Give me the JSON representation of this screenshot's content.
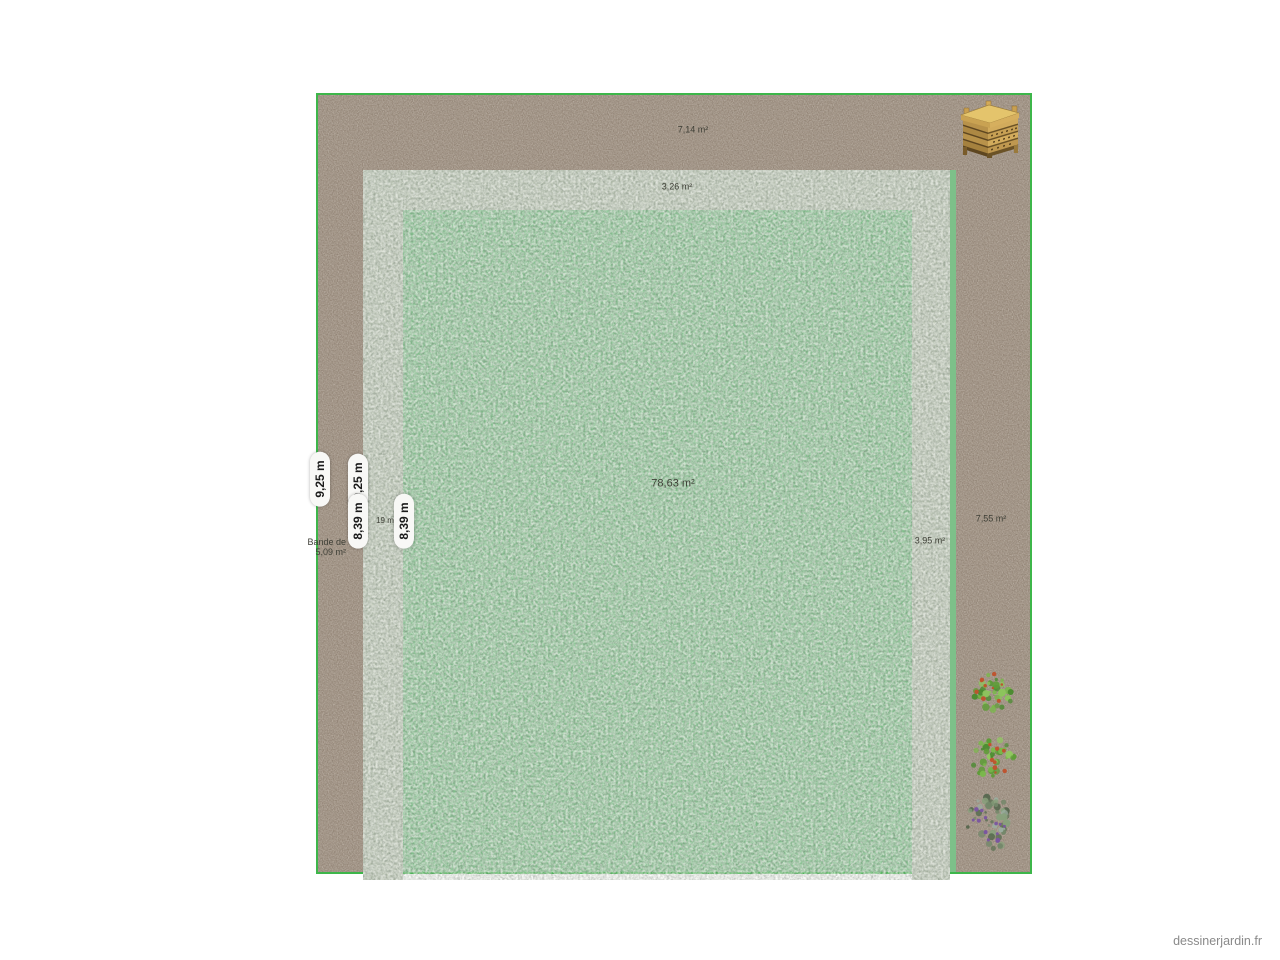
{
  "app": {
    "watermark": "dessinerjardin.fr"
  },
  "colors": {
    "soil": "#9b8c7d",
    "gravel": "#b9c3b1",
    "lawn": "#7dc089",
    "boundary": "#3db64a",
    "pill_bg": "#f8f8f6",
    "pill_text": "#1a1a1a",
    "label_text": "#3e3f36",
    "watermark_text": "#8a8a8a"
  },
  "plan": {
    "area_labels": [
      {
        "name": "soil-top-area",
        "text": "7,14 m²"
      },
      {
        "name": "gravel-top-area",
        "text": "3,26 m²"
      },
      {
        "name": "lawn-area",
        "text": "78,63 m²"
      },
      {
        "name": "soil-right-area",
        "text": "7,55 m²"
      },
      {
        "name": "gravel-right-area",
        "text": "3,95 m²"
      },
      {
        "name": "gravel-left-area",
        "text": "19 m"
      }
    ],
    "strip_label": {
      "line1": "Bande de",
      "line2": "5,09 m²"
    },
    "dimension_pills": [
      {
        "text": "9,25 m"
      },
      {
        "text": "9,25 m"
      },
      {
        "text": "8,39 m"
      },
      {
        "text": "8,39 m"
      }
    ],
    "objects": {
      "composter": {
        "name": "wooden-composter"
      },
      "plants": [
        {
          "name": "shrub-red-flowers-1",
          "palette": [
            "#5f9c38",
            "#79b84a",
            "#8cc45c",
            "#4a8a30"
          ],
          "accent": "#c0512c",
          "accents": 9,
          "leaves": 36
        },
        {
          "name": "shrub-red-flowers-2",
          "palette": [
            "#5f9c38",
            "#7ab84b",
            "#90c95f",
            "#4a8a30"
          ],
          "accent": "#c0512c",
          "accents": 8,
          "leaves": 36
        },
        {
          "name": "shrub-purple-flowers",
          "palette": [
            "#74876a",
            "#5d7054",
            "#88a07c",
            "#4e6247",
            "#9badA0"
          ],
          "accent": "#7a55a0",
          "accents": 14,
          "leaves": 44
        }
      ]
    }
  }
}
